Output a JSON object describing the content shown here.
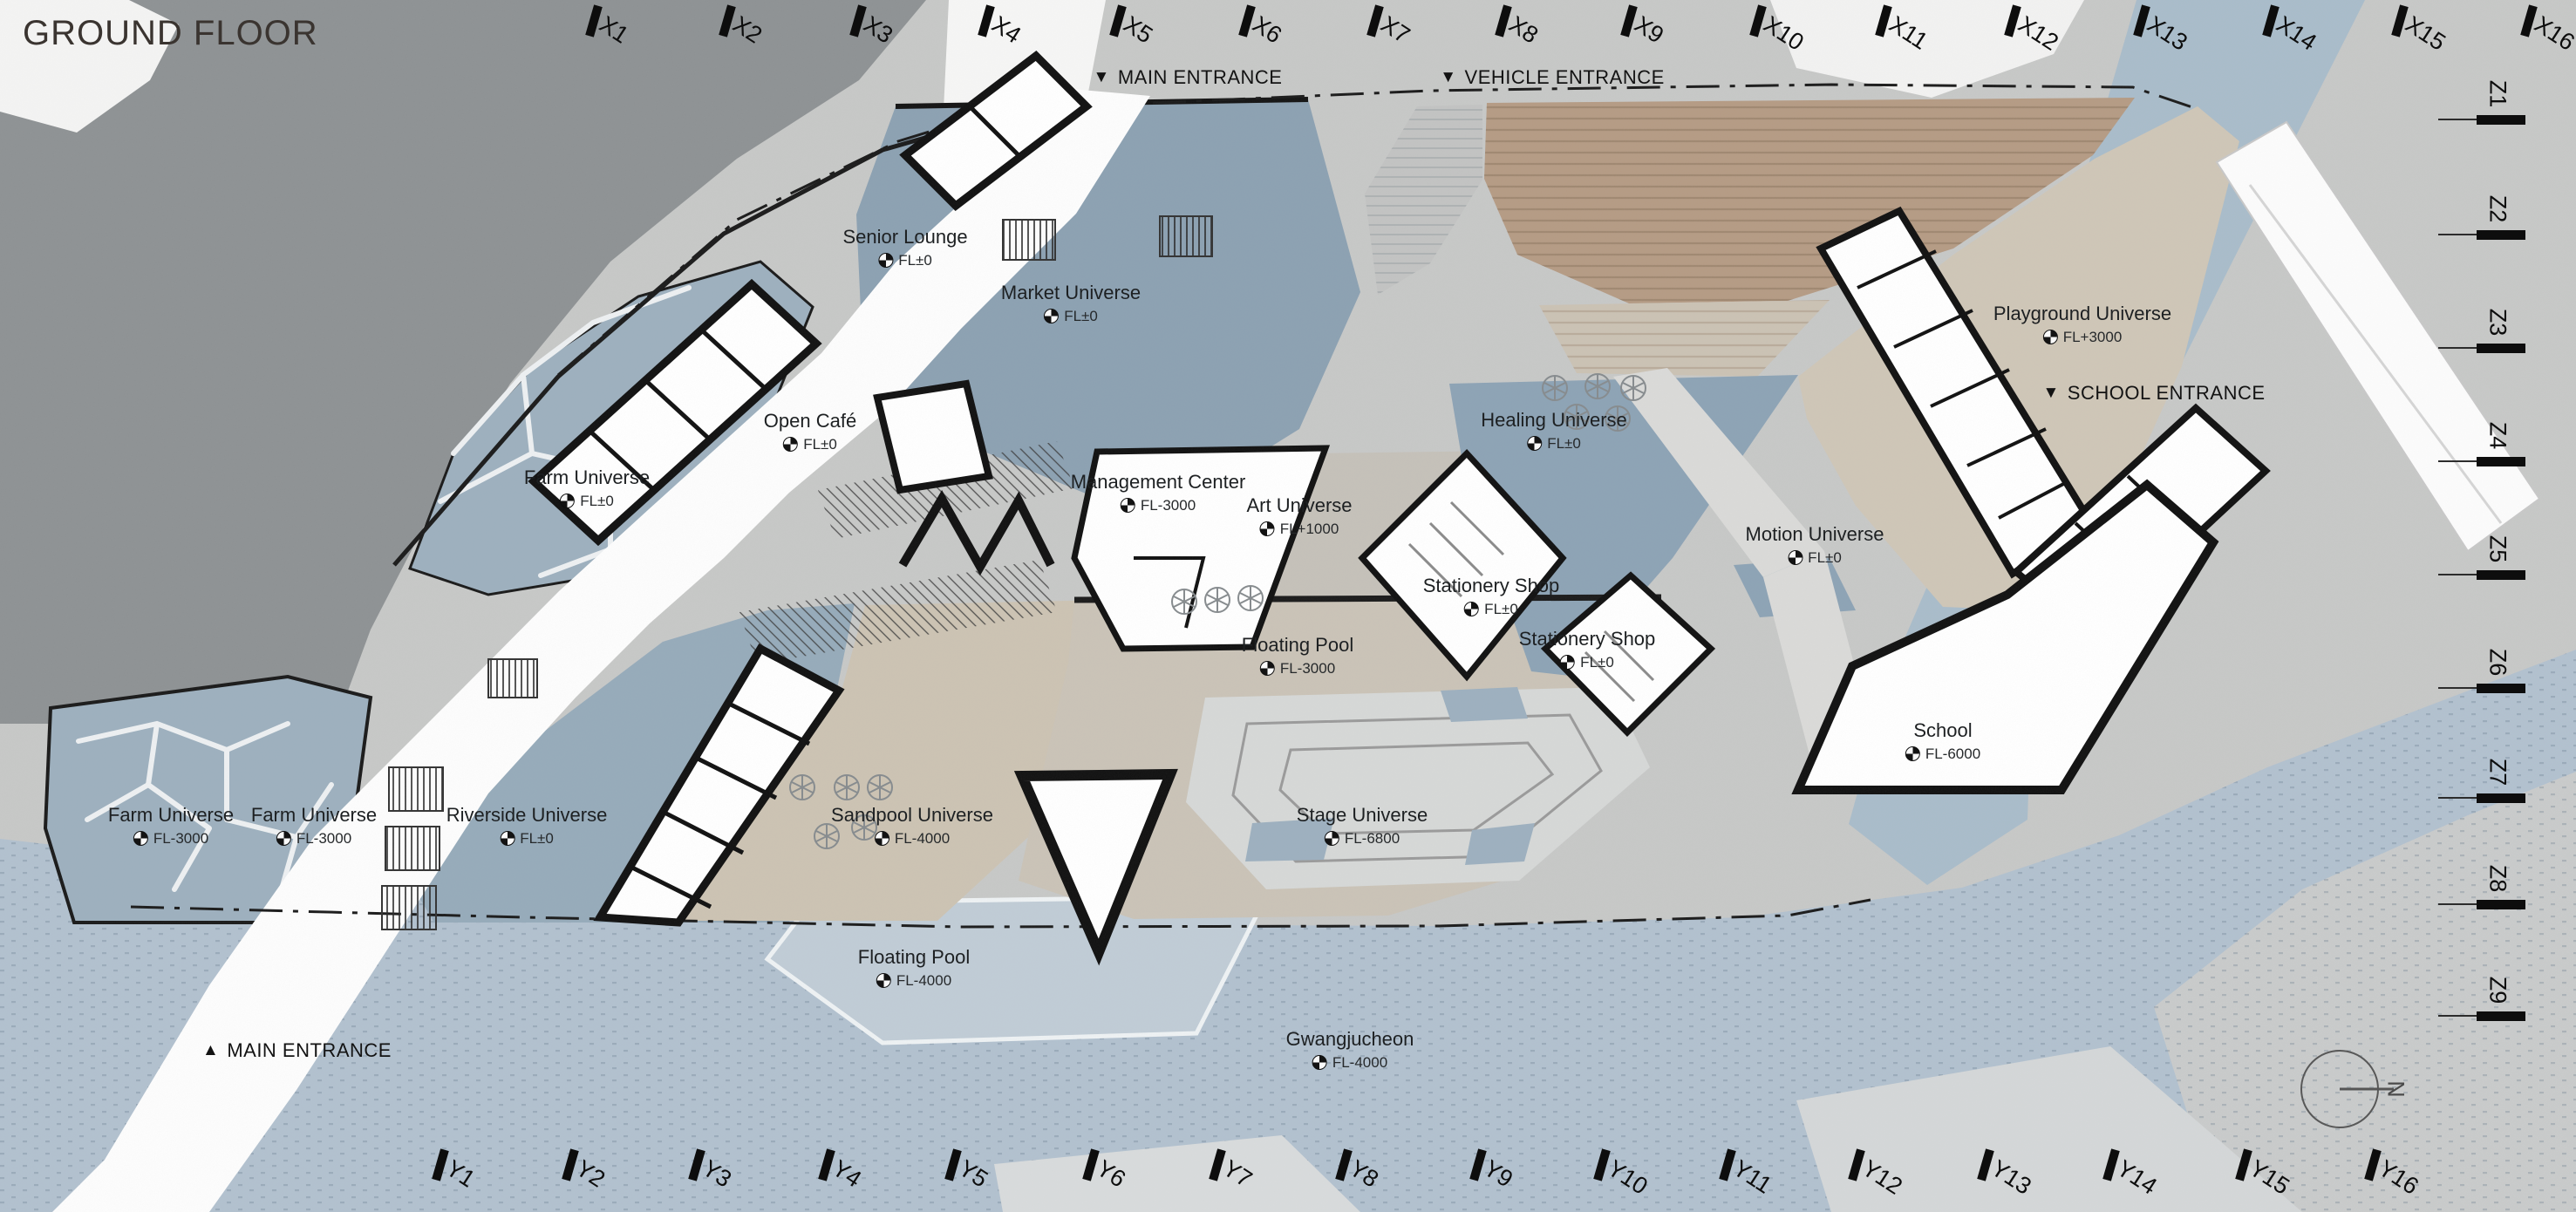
{
  "title": "GROUND FLOOR",
  "grid": {
    "x_labels": [
      "X1",
      "X2",
      "X3",
      "X4",
      "X5",
      "X6",
      "X7",
      "X8",
      "X9",
      "X10",
      "X11",
      "X12",
      "X13",
      "X14",
      "X15",
      "X16"
    ],
    "y_labels": [
      "Y1",
      "Y2",
      "Y3",
      "Y4",
      "Y5",
      "Y6",
      "Y7",
      "Y8",
      "Y9",
      "Y10",
      "Y11",
      "Y12",
      "Y13",
      "Y14",
      "Y15",
      "Y16"
    ],
    "z_labels": [
      "Z1",
      "Z2",
      "Z3",
      "Z4",
      "Z5",
      "Z6",
      "Z7",
      "Z8",
      "Z9"
    ]
  },
  "entrances": [
    {
      "arrow": "▼",
      "label": "MAIN ENTRANCE"
    },
    {
      "arrow": "▼",
      "label": "VEHICLE ENTRANCE"
    },
    {
      "arrow": "▼",
      "label": "SCHOOL ENTRANCE"
    },
    {
      "arrow": "▲",
      "label": "MAIN ENTRANCE"
    }
  ],
  "zones": [
    {
      "name": "Senior Lounge",
      "level": "FL±0"
    },
    {
      "name": "Market Universe",
      "level": "FL±0"
    },
    {
      "name": "Open Café",
      "level": "FL±0"
    },
    {
      "name": "Farm Universe",
      "level": "FL±0"
    },
    {
      "name": "Management Center",
      "level": "FL-3000"
    },
    {
      "name": "Art Universe",
      "level": "FL+1000"
    },
    {
      "name": "Healing Universe",
      "level": "FL±0"
    },
    {
      "name": "Stationery Shop",
      "level": "FL±0"
    },
    {
      "name": "Stationery Shop",
      "level": "FL±0"
    },
    {
      "name": "Motion Universe",
      "level": "FL±0"
    },
    {
      "name": "Playground Universe",
      "level": "FL+3000"
    },
    {
      "name": "School",
      "level": "FL-6000"
    },
    {
      "name": "Floating Pool",
      "level": "FL-3000"
    },
    {
      "name": "Farm Universe",
      "level": "FL-3000"
    },
    {
      "name": "Farm Universe",
      "level": "FL-3000"
    },
    {
      "name": "Riverside Universe",
      "level": "FL±0"
    },
    {
      "name": "Sandpool Universe",
      "level": "FL-4000"
    },
    {
      "name": "Stage Universe",
      "level": "FL-6800"
    },
    {
      "name": "Floating Pool",
      "level": "FL-4000"
    },
    {
      "name": "Gwangjucheon",
      "level": "FL-4000"
    }
  ],
  "compass": {
    "label": "N"
  },
  "palette": {
    "paper": "#c7c8c7",
    "hill": "#8e9294",
    "water": "#b2c1cf",
    "river_channel": "#a9bcca",
    "plaza_blue": "#8ca1b2",
    "farm_blue": "#9db0be",
    "sand_beige": "#ccc3b3",
    "deck_wood": "#b59b84",
    "playground_beige": "#cfc6b7",
    "building_white": "#ffffff",
    "wall_black": "#111111"
  }
}
